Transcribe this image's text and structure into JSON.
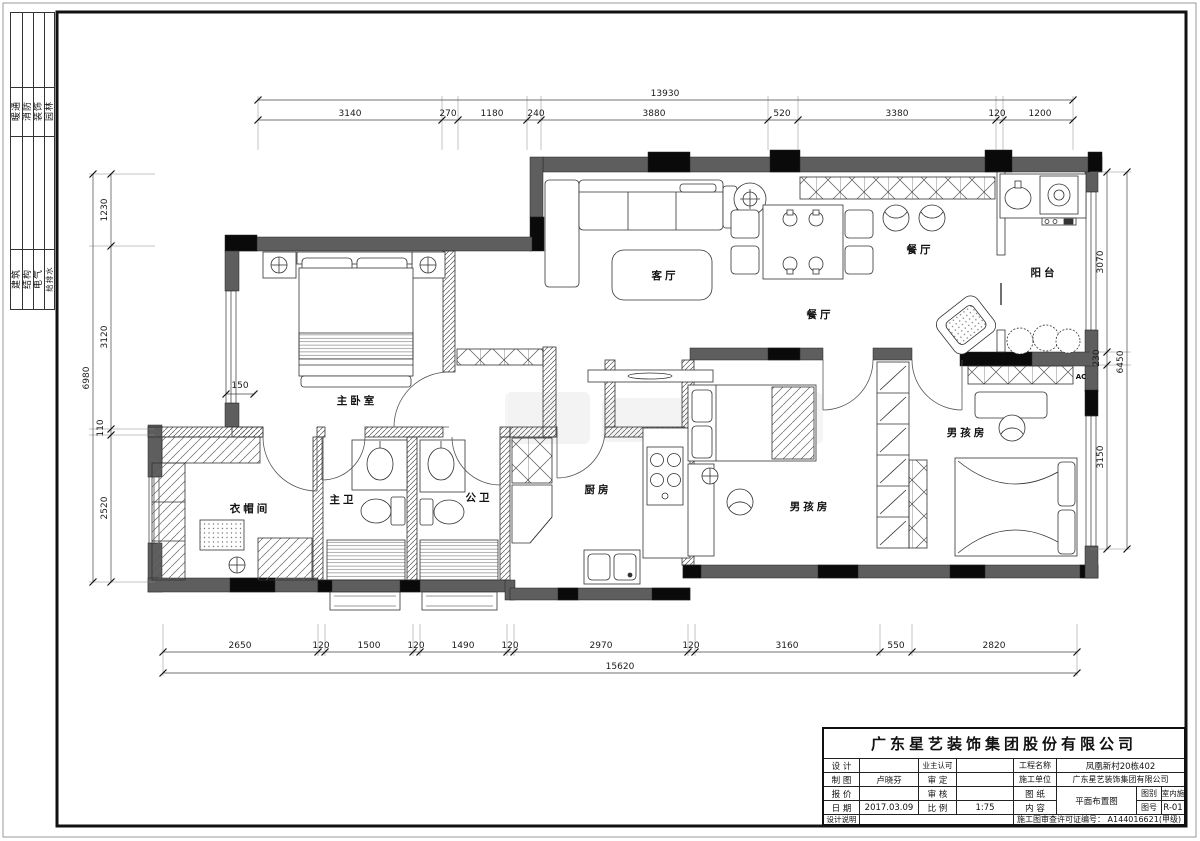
{
  "sheet": {
    "disciplines_top": [
      "暖通",
      "消防",
      "装饰",
      "园林"
    ],
    "disciplines_bottom": [
      "建筑",
      "结构",
      "电气",
      "给排水"
    ]
  },
  "plan": {
    "labels": {
      "living": "客厅",
      "dining_upper": "餐厅",
      "dining_lower": "餐厅",
      "balcony": "阳台",
      "master_bedroom": "主卧室",
      "cloakroom": "衣帽间",
      "master_bath": "主卫",
      "public_bath": "公卫",
      "kitchen": "厨房",
      "boy_room_left": "男孩房",
      "boy_room_right": "男孩房",
      "ac": "AC",
      "offset": "150"
    }
  },
  "dims": {
    "top": {
      "total": "13930",
      "segments": [
        "3140",
        "270",
        "1180",
        "240",
        "3880",
        "520",
        "3380",
        "120",
        "1200"
      ]
    },
    "bottom": {
      "total": "15620",
      "segments": [
        "2650",
        "120",
        "1500",
        "120",
        "1490",
        "120",
        "2970",
        "120",
        "3160",
        "550",
        "2820"
      ]
    },
    "left": {
      "total": "6980",
      "segments": [
        "1230",
        "3120",
        "110",
        "2520"
      ]
    },
    "right": {
      "total": "6450",
      "segments": [
        "3070",
        "230",
        "3150"
      ]
    }
  },
  "title_block": {
    "company": "广东星艺装饰集团股份有限公司",
    "design_label": "设 计",
    "owner_label": "业主认可",
    "project_label": "工程名称",
    "project_value": "凤凰新村20栋402",
    "draft_label": "制 图",
    "draft_value": "卢晓芬",
    "approve_label": "审 定",
    "builder_label": "施工单位",
    "builder_value": "广东星艺装饰集团有限公司",
    "quote_label": "报 价",
    "check_label": "审 核",
    "paper_label": "图 纸",
    "content_label": "内 容",
    "content_value": "平面布置图",
    "category_label": "图别",
    "category_value": "室内施",
    "date_label": "日 期",
    "date_value": "2017.03.09",
    "scale_label": "比 例",
    "scale_value": "1:75",
    "no_label": "图号",
    "no_value": "R-01",
    "notes_label": "设计说明",
    "permit": "施工图审查许可证编号： A144016621(甲级)"
  }
}
